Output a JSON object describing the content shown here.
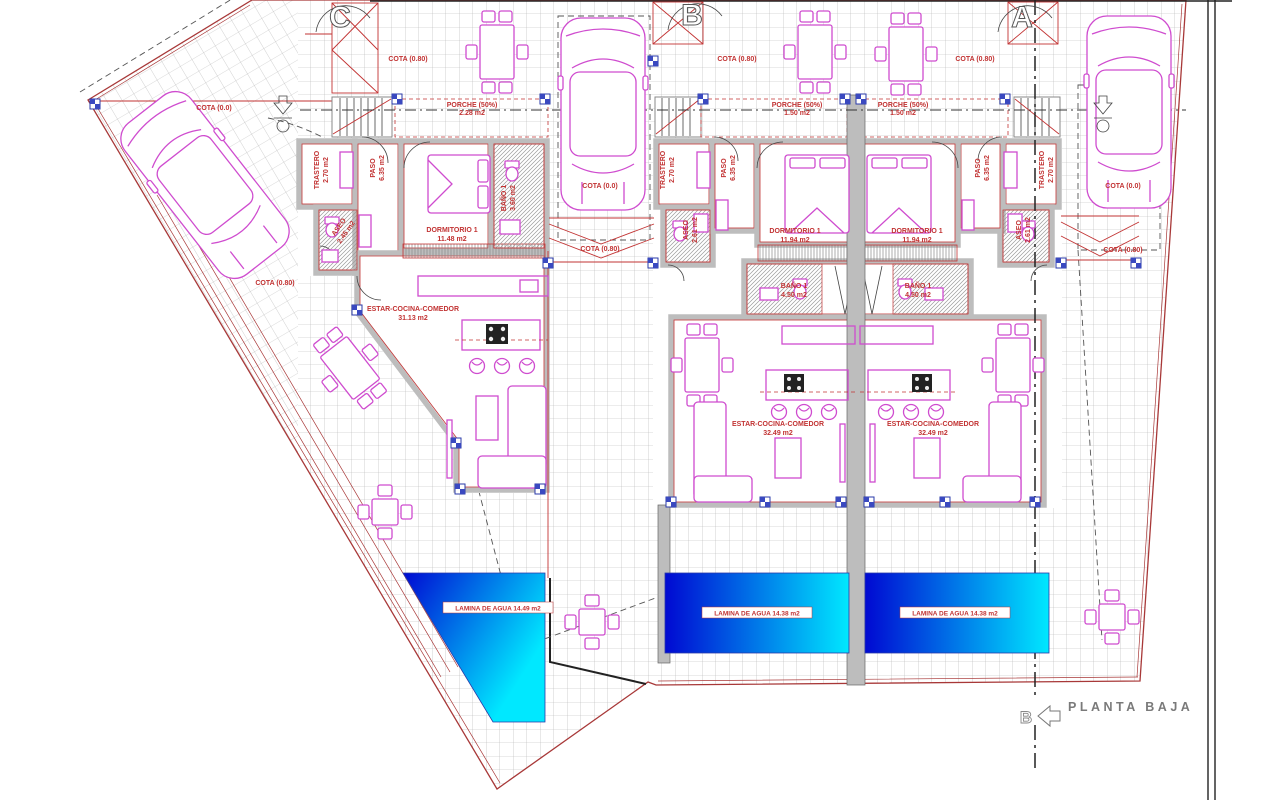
{
  "drawing": {
    "title": "PLANTA BAJA",
    "bottom_section_marker": "B"
  },
  "cotas": {
    "zero": "COTA (0.0)",
    "eighty": "COTA (0.80)"
  },
  "units": [
    {
      "letter": "C",
      "porche": {
        "name": "PORCHE (50%)",
        "area": "2.28 m2"
      },
      "trastero": {
        "name": "TRASTERO",
        "area": "2.70 m2"
      },
      "paso": {
        "name": "PASO",
        "area": "6.35 m2"
      },
      "dormitorio": {
        "name": "DORMITORIO 1",
        "area": "11.48 m2"
      },
      "bano": {
        "name": "BAÑO 1",
        "area": "3.60 m2"
      },
      "aseo": {
        "name": "ASEO",
        "area": "2.45 m2"
      },
      "estar": {
        "name": "ESTAR-COCINA-COMEDOR",
        "area": "31.13 m2"
      },
      "pool_label": "LAMINA DE AGUA 14.49 m2"
    },
    {
      "letter": "B",
      "porche": {
        "name": "PORCHE (50%)",
        "area": "1.50 m2"
      },
      "trastero": {
        "name": "TRASTERO",
        "area": "2.70 m2"
      },
      "paso": {
        "name": "PASO",
        "area": "6.35 m2"
      },
      "dormitorio": {
        "name": "DORMITORIO 1",
        "area": "11.94 m2"
      },
      "bano": {
        "name": "BAÑO 1",
        "area": "4.50 m2"
      },
      "aseo": {
        "name": "ASEO",
        "area": "2.61 m2"
      },
      "estar": {
        "name": "ESTAR-COCINA-COMEDOR",
        "area": "32.49 m2"
      },
      "pool_label": "LAMINA DE AGUA 14.38 m2"
    },
    {
      "letter": "A",
      "porche": {
        "name": "PORCHE (50%)",
        "area": "1.50 m2"
      },
      "trastero": {
        "name": "TRASTERO",
        "area": "2.70 m2"
      },
      "paso": {
        "name": "PASO",
        "area": "6.35 m2"
      },
      "dormitorio": {
        "name": "DORMITORIO 1",
        "area": "11.94 m2"
      },
      "bano": {
        "name": "BAÑO 1",
        "area": "4.50 m2"
      },
      "aseo": {
        "name": "ASEO",
        "area": "2.61 m2"
      },
      "estar": {
        "name": "ESTAR-COCINA-COMEDOR",
        "area": "32.49 m2"
      },
      "pool_label": "LAMINA DE AGUA 14.38 m2"
    }
  ],
  "colors": {
    "plot_line_red": "#a83838",
    "label_red": "#c23333",
    "furniture_magenta": "#cf4ccf",
    "wall_gray": "#bdbdbd",
    "pool_dark": "#0009d2",
    "pool_light": "#00e8ff",
    "window_blue": "#3a49c0"
  }
}
